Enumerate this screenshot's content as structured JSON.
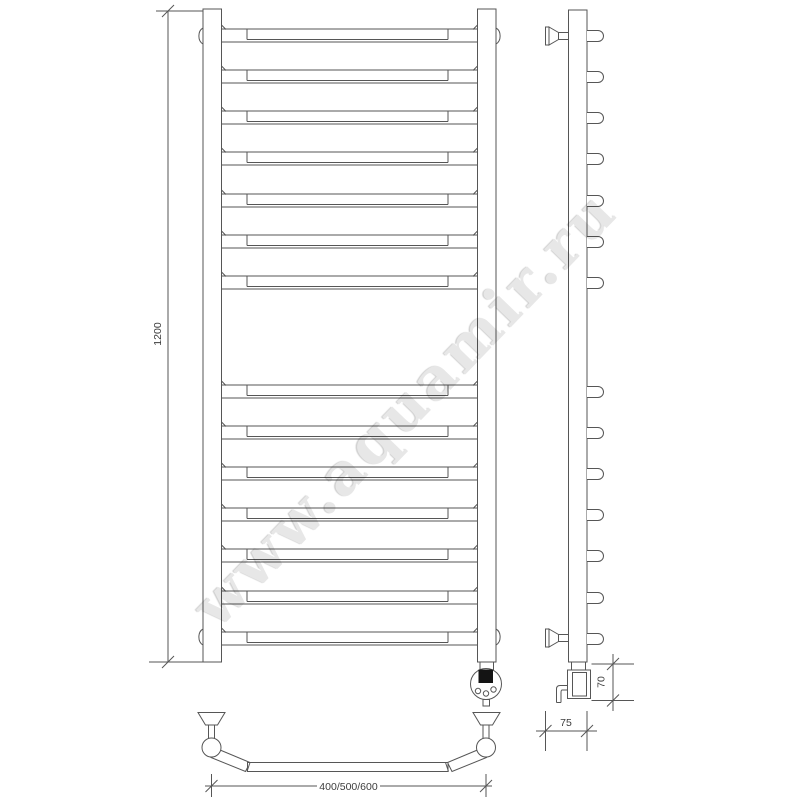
{
  "watermark": "www.aquamir.ru",
  "dimensions": {
    "height_label": "1200",
    "width_label": "400/500/600",
    "depth_label": "75",
    "heater_height_label": "70"
  },
  "front_view": {
    "rung_tops": [
      29,
      70,
      111,
      152,
      194,
      235,
      276,
      385,
      426,
      467,
      508,
      549,
      591,
      632
    ],
    "rung_height": 13
  },
  "side_view": {
    "stub_tops": [
      29,
      70,
      111,
      152,
      194,
      235,
      276,
      385,
      426,
      467,
      508,
      549,
      591,
      632
    ]
  },
  "colors": {
    "line": "#565656",
    "display": "#141414",
    "watermark": "#e7e7e7",
    "background": "#ffffff"
  }
}
